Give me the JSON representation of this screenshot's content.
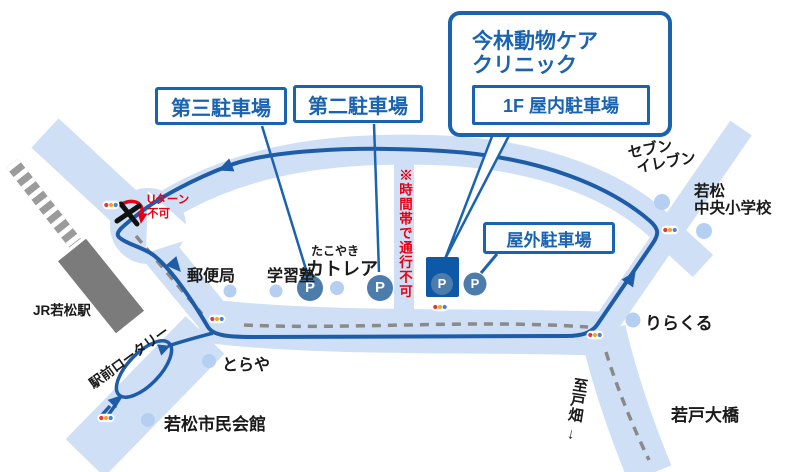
{
  "clinic_callout": {
    "name_line1": "今林動物ケア",
    "name_line2": "クリニック",
    "indoor_parking": "1F 屋内駐車場"
  },
  "parking": {
    "third_lot": "第三駐車場",
    "second_lot": "第二駐車場",
    "outdoor_lot": "屋外駐車場",
    "marker_letter": "P"
  },
  "warnings": {
    "time_restricted": "※時間帯で通行不可",
    "no_uturn_line1": "Uターン",
    "no_uturn_line2": "不可"
  },
  "landmarks": {
    "station": "JR若松駅",
    "rotary": "駅前ロータリー",
    "post_office": "郵便局",
    "cram_school": "学習塾",
    "takoyaki_small": "たこやき",
    "takoyaki_name": "カトレア",
    "toraya": "とらや",
    "civic_hall": "若松市民会館",
    "seven_line1": "セブン",
    "seven_line2": "イレブン",
    "school_line1": "若松",
    "school_line2": "中央小学校",
    "rirakuru": "りらくる",
    "bridge": "若戸大橋",
    "to_tobata": "至戸畑",
    "to_tobata_arrow": "↓"
  },
  "colors": {
    "road": "#cfe0f6",
    "route": "#1e5ca8",
    "accent_blue": "#1a63b0",
    "warning_red": "#e60012",
    "parking_circle": "#4c7cac",
    "clinic_building": "#0e59a5",
    "landmark_dot": "#b5cff2",
    "railway": "#9b9b9b",
    "station_fill": "#7b7b7b",
    "center_dash": "#8a8a8a",
    "signal_red": "#e53935",
    "signal_amber": "#f5a623",
    "signal_blue": "#4b7fe0"
  }
}
